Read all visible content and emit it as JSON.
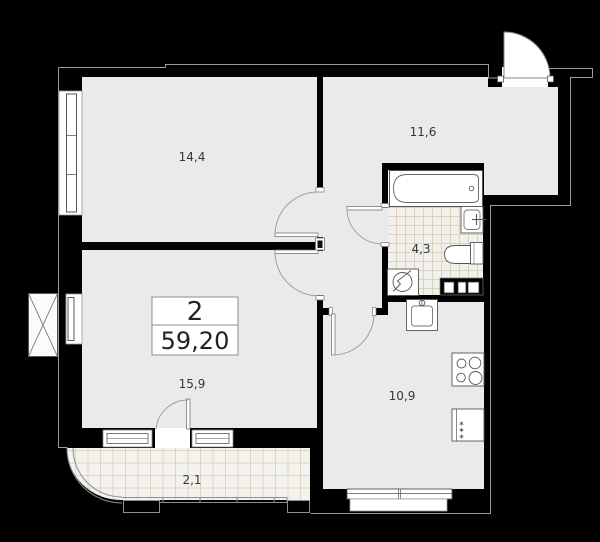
{
  "floor_plan": {
    "apartment": {
      "rooms_count": "2",
      "total_area": "59,20"
    },
    "rooms": [
      {
        "name": "living-room",
        "area_label": "14,4"
      },
      {
        "name": "hallway",
        "area_label": "11,6"
      },
      {
        "name": "bathroom",
        "area_label": "4,3"
      },
      {
        "name": "bedroom",
        "area_label": "15,9"
      },
      {
        "name": "kitchen",
        "area_label": "10,9"
      },
      {
        "name": "balcony",
        "area_label": "2,1"
      }
    ],
    "icons": {
      "vent_symbol": "circle-zigzag-vent-icon",
      "shaft_symbol": "x-cross-shaft-icon",
      "fridge_mark": "*"
    },
    "colors": {
      "background": "#000000",
      "room_fill": "#e8eaec",
      "outline": "#9c9c9c",
      "fixture_stroke": "#555555",
      "bath_tile_line": "#d9d2c3",
      "balcony_tile_line": "#dcd6c8"
    }
  }
}
